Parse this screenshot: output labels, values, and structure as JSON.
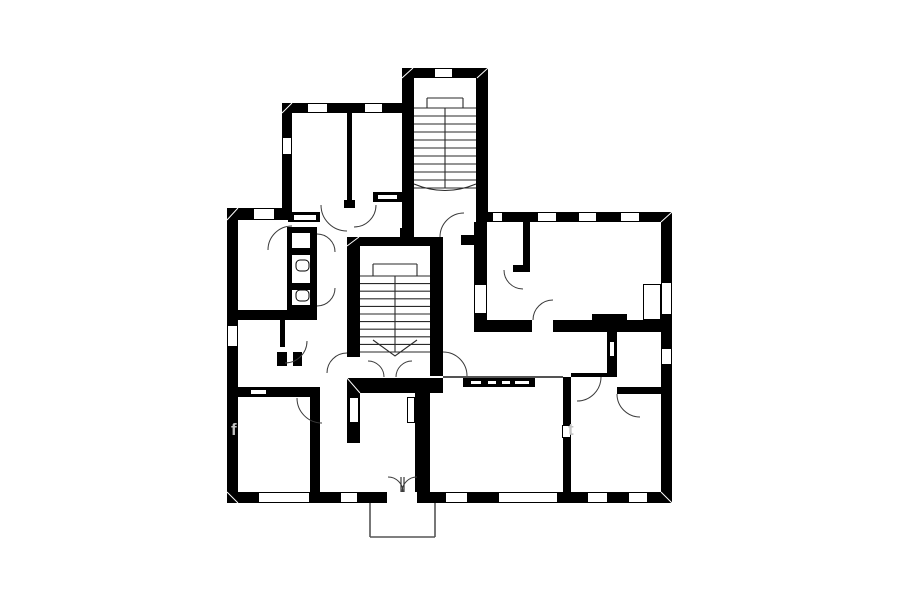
{
  "canvas": {
    "width": 900,
    "height": 604,
    "background": "#ffffff"
  },
  "style": {
    "wall_color": "#000000",
    "line_color": "#1c1c1c",
    "window_fill": "#ffffff",
    "window_stroke": "#000000",
    "stair_line": "#2a2a2a",
    "porch_line": "#555555",
    "watermark_color": "#c4c4c4"
  },
  "floorplan": {
    "walls": [
      [
        282,
        103,
        120,
        10
      ],
      [
        282,
        113,
        10,
        99
      ],
      [
        347,
        113,
        5,
        90
      ],
      [
        344,
        200,
        11,
        8
      ],
      [
        373,
        192,
        29,
        10
      ],
      [
        402,
        68,
        86,
        10
      ],
      [
        402,
        78,
        12,
        152
      ],
      [
        476,
        78,
        12,
        137
      ],
      [
        227,
        208,
        65,
        12
      ],
      [
        227,
        220,
        11,
        283
      ],
      [
        227,
        492,
        445,
        11
      ],
      [
        288,
        212,
        32,
        10
      ],
      [
        476,
        212,
        196,
        10
      ],
      [
        661,
        222,
        11,
        270
      ],
      [
        474,
        222,
        13,
        62
      ],
      [
        474,
        314,
        13,
        18
      ],
      [
        461,
        235,
        13,
        10
      ],
      [
        523,
        222,
        7,
        45
      ],
      [
        513,
        265,
        17,
        7
      ],
      [
        487,
        320,
        45,
        12
      ],
      [
        553,
        320,
        108,
        12
      ],
      [
        592,
        314,
        35,
        6
      ],
      [
        347,
        237,
        96,
        9
      ],
      [
        347,
        246,
        13,
        111
      ],
      [
        430,
        246,
        13,
        130
      ],
      [
        400,
        228,
        14,
        9
      ],
      [
        347,
        378,
        96,
        15
      ],
      [
        415,
        393,
        15,
        99
      ],
      [
        347,
        393,
        13,
        50
      ],
      [
        463,
        378,
        72,
        9
      ],
      [
        563,
        377,
        8,
        115
      ],
      [
        571,
        373,
        36,
        4
      ],
      [
        607,
        332,
        10,
        45
      ],
      [
        617,
        387,
        44,
        7
      ],
      [
        238,
        310,
        79,
        10
      ],
      [
        238,
        387,
        82,
        10
      ],
      [
        310,
        387,
        10,
        105
      ],
      [
        280,
        315,
        5,
        32
      ],
      [
        287,
        227,
        30,
        6
      ],
      [
        287,
        227,
        5,
        85
      ],
      [
        310,
        227,
        7,
        85
      ],
      [
        287,
        248,
        30,
        7
      ],
      [
        287,
        283,
        30,
        7
      ],
      [
        287,
        305,
        30,
        7
      ],
      [
        277,
        352,
        10,
        14
      ],
      [
        293,
        352,
        9,
        14
      ]
    ],
    "windows": [
      [
        307,
        103,
        21,
        10
      ],
      [
        364,
        103,
        19,
        10
      ],
      [
        434,
        68,
        19,
        10
      ],
      [
        282,
        137,
        10,
        18
      ],
      [
        253,
        208,
        22,
        12
      ],
      [
        227,
        325,
        11,
        22
      ],
      [
        492,
        212,
        11,
        10
      ],
      [
        537,
        212,
        20,
        10
      ],
      [
        578,
        212,
        19,
        10
      ],
      [
        620,
        212,
        20,
        10
      ],
      [
        661,
        282,
        11,
        33
      ],
      [
        661,
        348,
        11,
        17
      ],
      [
        258,
        492,
        52,
        11
      ],
      [
        340,
        492,
        18,
        11
      ],
      [
        445,
        492,
        23,
        11
      ],
      [
        498,
        492,
        60,
        11
      ],
      [
        587,
        492,
        21,
        11
      ],
      [
        628,
        492,
        20,
        11
      ],
      [
        474,
        284,
        13,
        30
      ],
      [
        643,
        284,
        18,
        36
      ],
      [
        470,
        380,
        12,
        5
      ],
      [
        487,
        380,
        10,
        5
      ],
      [
        501,
        380,
        10,
        5
      ],
      [
        514,
        380,
        16,
        5
      ],
      [
        349,
        397,
        10,
        26
      ],
      [
        407,
        397,
        8,
        26
      ],
      [
        250,
        389,
        17,
        6
      ],
      [
        293,
        214,
        24,
        7
      ],
      [
        377,
        194,
        21,
        6
      ],
      [
        562,
        425,
        9,
        13
      ],
      [
        609,
        341,
        6,
        16
      ]
    ],
    "entry_gaps": [
      [
        387,
        492,
        30,
        11
      ]
    ],
    "stairs": [
      {
        "name": "upper-stairwell",
        "x": 414,
        "y": 78,
        "w": 62,
        "h": 137,
        "treads_top": 108,
        "treads_bottom": 188,
        "tread_count": 11,
        "divider_x": 445,
        "rail": {
          "x1": 427,
          "x2": 463,
          "y1": 98,
          "y2": 108
        },
        "curve": {
          "type": "arc",
          "x1": 414,
          "y1": 184,
          "qx": 445,
          "qy": 197,
          "x2": 476,
          "y2": 184
        }
      },
      {
        "name": "central-stairwell",
        "x": 360,
        "y": 246,
        "w": 70,
        "h": 130,
        "treads_top": 276,
        "treads_bottom": 352,
        "tread_count": 11,
        "divider_x": 395,
        "rail": {
          "x1": 373,
          "x2": 417,
          "y1": 264,
          "y2": 276
        },
        "curve": {
          "type": "chevron",
          "x1": 373,
          "y1": 340,
          "qx": 395,
          "qy": 356,
          "x2": 417,
          "y2": 340
        }
      }
    ],
    "doors": [
      {
        "cx": 347,
        "cy": 205,
        "r": 26,
        "a1": 90,
        "a2": 180
      },
      {
        "cx": 354,
        "cy": 205,
        "r": 22,
        "a1": 0,
        "a2": 90
      },
      {
        "cx": 292,
        "cy": 250,
        "r": 24,
        "a1": 180,
        "a2": 270
      },
      {
        "cx": 464,
        "cy": 237,
        "r": 24,
        "a1": 180,
        "a2": 270
      },
      {
        "cx": 523,
        "cy": 270,
        "r": 19,
        "a1": 90,
        "a2": 180
      },
      {
        "cx": 553,
        "cy": 320,
        "r": 20,
        "a1": 180,
        "a2": 270
      },
      {
        "cx": 347,
        "cy": 373,
        "r": 20,
        "a1": 180,
        "a2": 270
      },
      {
        "cx": 443,
        "cy": 376,
        "r": 24,
        "a1": 270,
        "a2": 360
      },
      {
        "cx": 368,
        "cy": 377,
        "r": 16,
        "a1": 270,
        "a2": 360
      },
      {
        "cx": 412,
        "cy": 377,
        "r": 16,
        "a1": 180,
        "a2": 270
      },
      {
        "cx": 577,
        "cy": 377,
        "r": 24,
        "a1": 0,
        "a2": 90
      },
      {
        "cx": 640,
        "cy": 394,
        "r": 23,
        "a1": 90,
        "a2": 180
      },
      {
        "cx": 388,
        "cy": 492,
        "r": 15,
        "a1": 270,
        "a2": 360
      },
      {
        "cx": 417,
        "cy": 492,
        "r": 15,
        "a1": 180,
        "a2": 270
      },
      {
        "cx": 317,
        "cy": 252,
        "r": 18,
        "a1": 270,
        "a2": 360
      },
      {
        "cx": 317,
        "cy": 288,
        "r": 18,
        "a1": 0,
        "a2": 90
      },
      {
        "cx": 322,
        "cy": 398,
        "r": 25,
        "a1": 90,
        "a2": 180
      },
      {
        "cx": 285,
        "cy": 341,
        "r": 22,
        "a1": 0,
        "a2": 90
      }
    ],
    "door_leaves": [
      [
        401,
        477,
        401,
        492
      ],
      [
        404,
        477,
        404,
        492
      ]
    ],
    "thin_lines": [
      [
        443,
        377,
        563,
        377
      ]
    ],
    "miters": [
      [
        227,
        220,
        238,
        208
      ],
      [
        402,
        78,
        413,
        68
      ],
      [
        477,
        78,
        488,
        68
      ],
      [
        661,
        222,
        672,
        212
      ],
      [
        227,
        492,
        238,
        503
      ],
      [
        661,
        492,
        672,
        503
      ],
      [
        347,
        246,
        359,
        237
      ],
      [
        282,
        113,
        292,
        103
      ],
      [
        347,
        378,
        360,
        393
      ]
    ],
    "porch_lines": [
      [
        370,
        503,
        370,
        537
      ],
      [
        370,
        537,
        435,
        537
      ],
      [
        435,
        537,
        435,
        503
      ]
    ],
    "fixtures": [
      {
        "x": 296,
        "y": 260,
        "w": 13,
        "h": 11,
        "rx": 4
      },
      {
        "x": 296,
        "y": 290,
        "w": 13,
        "h": 11,
        "rx": 4
      }
    ]
  },
  "watermarks": [
    {
      "text": "f",
      "x": 231,
      "y": 435
    },
    {
      "text": "t",
      "x": 568,
      "y": 435
    }
  ]
}
